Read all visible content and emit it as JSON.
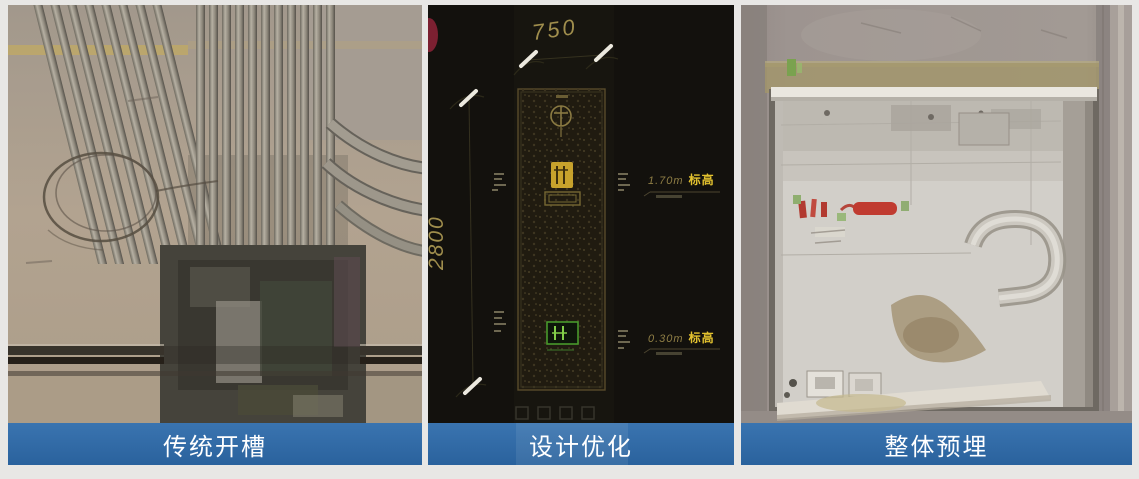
{
  "figure": {
    "background": "#e8e7e5",
    "label_bar_color": "#2d6ba7",
    "label_text_color": "#ffffff"
  },
  "panels": {
    "left": {
      "label": "传统开槽"
    },
    "middle": {
      "label": "设计优化",
      "cad": {
        "width_dim": "750",
        "height_dim": "2800",
        "elevations": {
          "upper": {
            "value": "1.70m",
            "tag": "标高"
          },
          "lower": {
            "value": "0.30m",
            "tag": "标高"
          }
        }
      }
    },
    "right": {
      "label": "整体预埋"
    }
  }
}
